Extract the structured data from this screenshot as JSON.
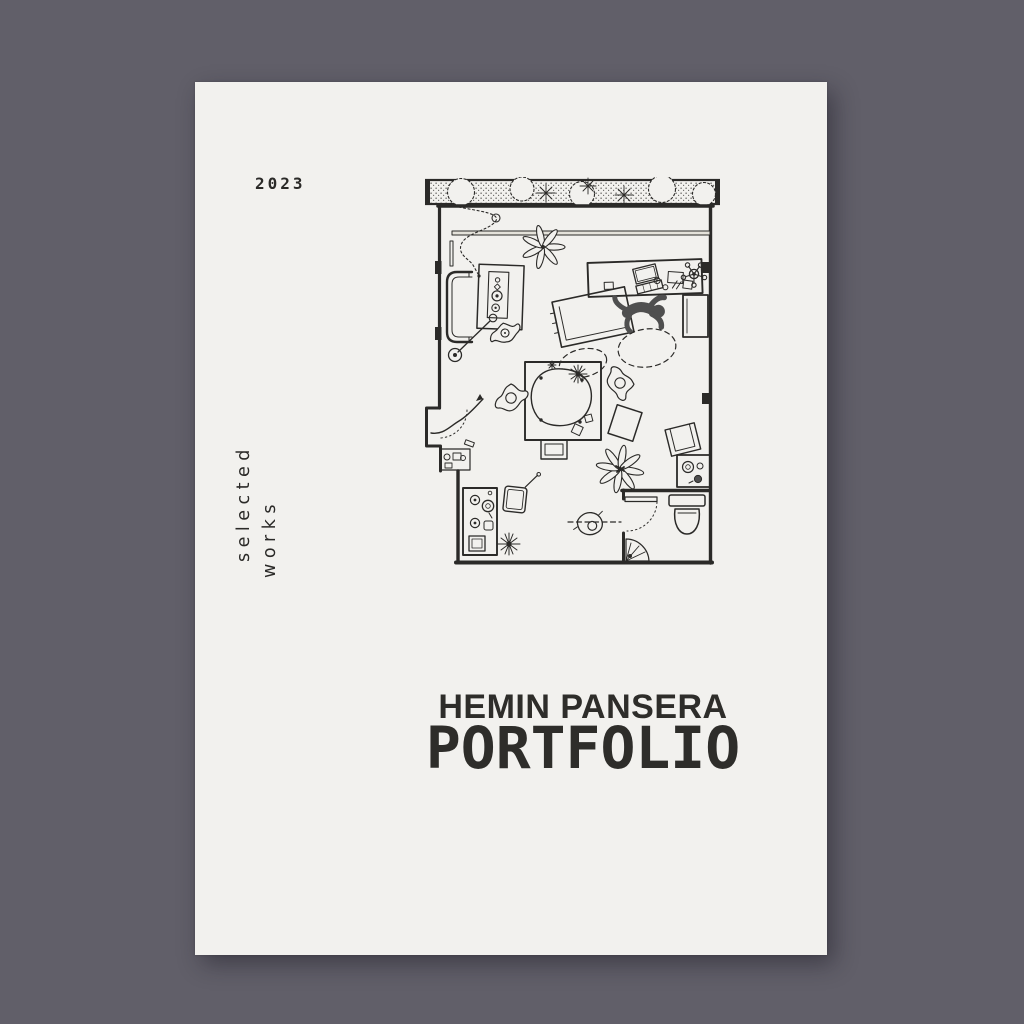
{
  "window": {
    "background_color": "#615f69"
  },
  "poster": {
    "paper_color": "#f2f1ee",
    "ink_color": "#2b2a28",
    "year": "2023",
    "side_text": {
      "line1": "selected",
      "line2": "works"
    },
    "author": "HEMIN PANSERA",
    "title": "PORTFOLIO"
  },
  "floorplan": {
    "type": "hand-drawn apartment floor plan illustration",
    "figure_color": "#4f4f4f",
    "elements": [
      "planted balcony strip with shrubs and flowers",
      "window band",
      "sofa with coffee table and floor lamp",
      "desk with laptop, papers and office chair",
      "person lying on floor beside a mat",
      "dashed walking paths",
      "dining table with organic rug and two chairs",
      "kitchen counter with sink and stove",
      "houseplants",
      "entry nook with door swing and arrow path",
      "bathroom with toilet, vanity and corner shower",
      "armchair and stool"
    ]
  }
}
